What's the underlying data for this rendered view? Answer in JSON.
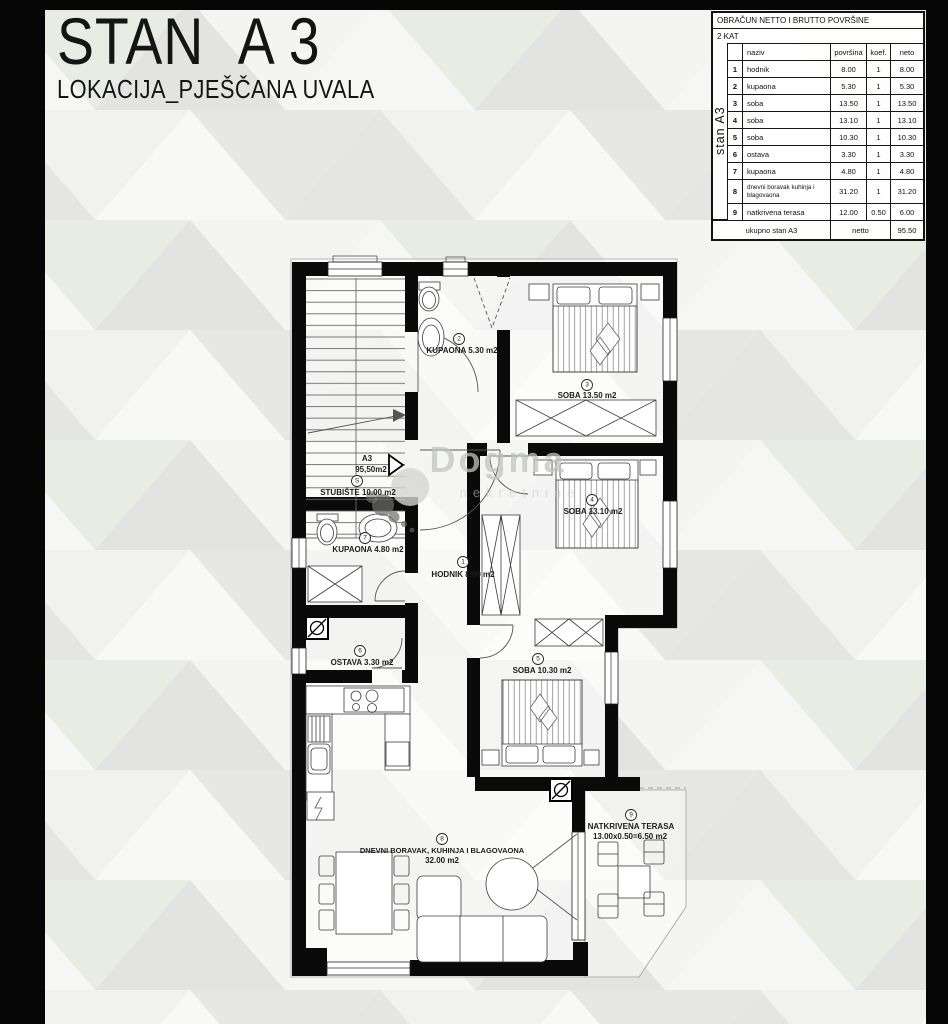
{
  "title": {
    "main_left": "STAN",
    "main_right": "A 3",
    "subtitle": "LOKACIJA_PJEŠČANA UVALA"
  },
  "table": {
    "header1": "OBRAČUN NETTO I BRUTTO POVRŠINE",
    "header2": "2 KAT",
    "side_label": "stan A3",
    "columns": {
      "naziv": "naziv",
      "povrsina": "površina",
      "koef": "koef.",
      "neto": "neto"
    },
    "rows": [
      {
        "num": "1",
        "naziv": "hodnik",
        "povrsina": "8.00",
        "koef": "1",
        "neto": "8.00"
      },
      {
        "num": "2",
        "naziv": "kupaona",
        "povrsina": "5.30",
        "koef": "1",
        "neto": "5.30"
      },
      {
        "num": "3",
        "naziv": "soba",
        "povrsina": "13.50",
        "koef": "1",
        "neto": "13.50"
      },
      {
        "num": "4",
        "naziv": "soba",
        "povrsina": "13.10",
        "koef": "1",
        "neto": "13.10"
      },
      {
        "num": "5",
        "naziv": "soba",
        "povrsina": "10.30",
        "koef": "1",
        "neto": "10.30"
      },
      {
        "num": "6",
        "naziv": "ostava",
        "povrsina": "3.30",
        "koef": "1",
        "neto": "3.30"
      },
      {
        "num": "7",
        "naziv": "kupaona",
        "povrsina": "4.80",
        "koef": "1",
        "neto": "4.80"
      },
      {
        "num": "8",
        "naziv": "dnevni boravak kuhinja i blagovaona",
        "povrsina": "31.20",
        "koef": "1",
        "neto": "31.20"
      },
      {
        "num": "9",
        "naziv": "natkrivena terasa",
        "povrsina": "12.00",
        "koef": "0.50",
        "neto": "6.00"
      }
    ],
    "footer": {
      "label": "ukupno stan A3",
      "netto_label": "netto",
      "total": "95.50"
    }
  },
  "plan": {
    "unit": {
      "name": "A3",
      "area": "95,50m2"
    },
    "labels": {
      "stubiste": {
        "num": "S",
        "text": "STUBIŠTE 10.00 m2"
      },
      "kupaona2": {
        "num": "2",
        "text": "KUPAONA 5.30 m2"
      },
      "soba3": {
        "num": "3",
        "text": "SOBA 13.50 m2"
      },
      "soba4": {
        "num": "4",
        "text": "SOBA 13.10 m2"
      },
      "soba5": {
        "num": "5",
        "text": "SOBA 10.30 m2"
      },
      "kupaona7": {
        "num": "7",
        "text": "KUPAONA 4.80 m2"
      },
      "hodnik": {
        "num": "1",
        "text": "HODNIK 8.00 m2"
      },
      "ostava": {
        "num": "6",
        "text": "OSTAVA 3.30 m2"
      },
      "dnevni": {
        "num": "8",
        "text": "DNEVNI BORAVAK, KUHINJA I BLAGOVAONA",
        "text2": "32.00 m2"
      },
      "terasa": {
        "num": "9",
        "text": "NATKRIVENA TERASA",
        "text2": "13.00x0.50=6.50 m2"
      }
    },
    "watermark": {
      "line1": "Dogma",
      "line2": "nekretnine"
    },
    "colors": {
      "wall": "#0a0a0a",
      "accent_bg": "#e9ebe5",
      "paper": "#ffffff"
    }
  }
}
